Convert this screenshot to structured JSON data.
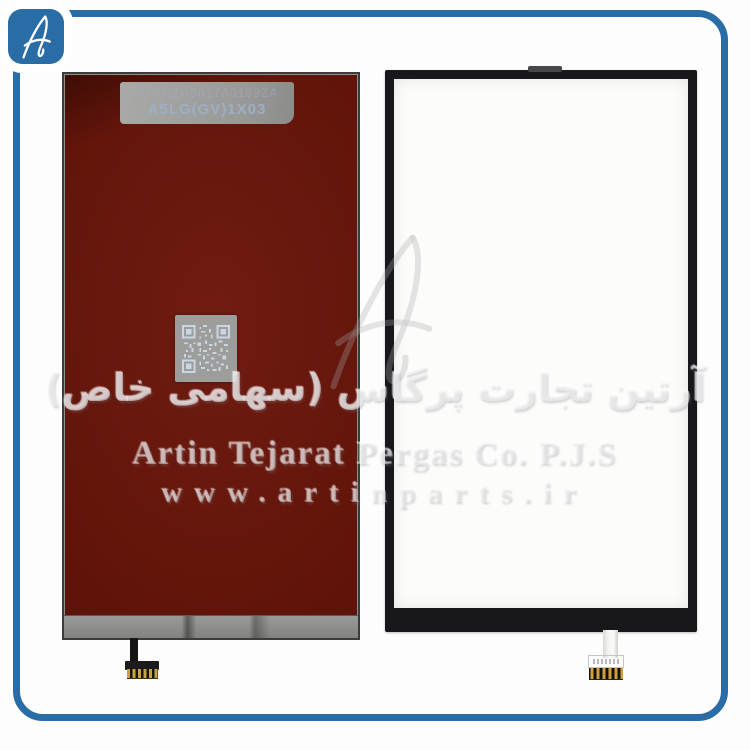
{
  "photo": {
    "logo_monogram": "A",
    "left_panel": {
      "label_line1": "Y7CRZG5017A0199ZA",
      "label_line2": "A5LG(GV)1X03"
    },
    "watermark": {
      "line_fa": "آرتین تجارت پرگاس (سهامی خاص)",
      "line_en": "Artin Tejarat Pergas Co. P.J.S",
      "line_url": "www.artinparts.ir"
    },
    "colors": {
      "frame_blue": "#2a6ca6",
      "panel_red": "#5e130e",
      "metal_gray": "#8e8e8c",
      "panel_black": "#18181b",
      "gold": "#caa044"
    }
  }
}
